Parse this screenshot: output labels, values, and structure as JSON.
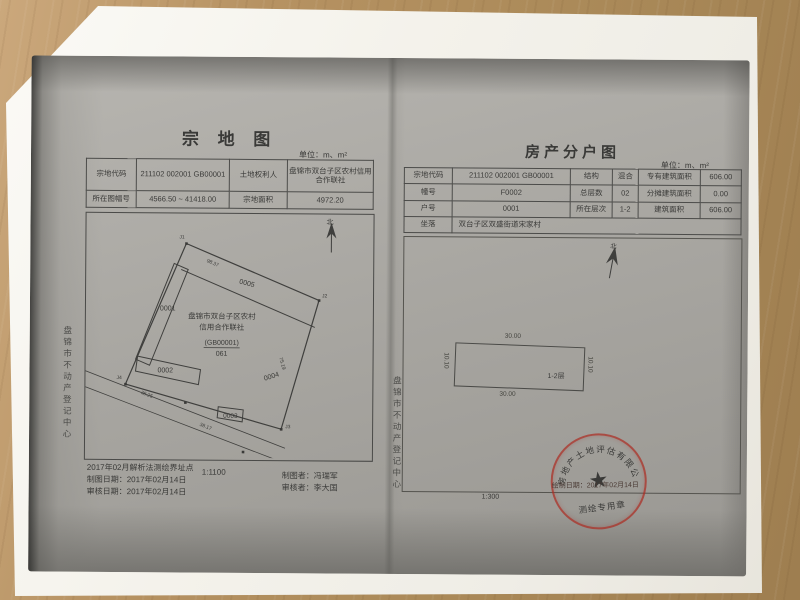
{
  "colors": {
    "stamp_red": "#ac2c22",
    "ink": "#3a3a38",
    "paper": "#f6f4ee",
    "copy_gray": "#a9a7a2",
    "desk_wood": "#b08c5e"
  },
  "left_page": {
    "title": "宗 地 图",
    "unit_label": "单位：m、m²",
    "header": {
      "parcel_code_label": "宗地代码",
      "parcel_code": "211102 002001 GB00001",
      "owner_label": "土地权利人",
      "owner": "盘锦市双台子区农村信用合作联社",
      "sheet_no_label": "所在图幅号",
      "sheet_no": "4566.50 ~ 41418.00",
      "area_label": "宗地面积",
      "area": "4972.20"
    },
    "map": {
      "north_label": "北",
      "owner_line1": "盘锦市双台子区农村",
      "owner_line2": "信用合作联社",
      "code": "(GB00001)",
      "sub_code": "061",
      "parcels": {
        "p1": "0001",
        "p2": "0002",
        "p3": "0003",
        "p4": "0004",
        "p5": "0005"
      },
      "measurements": {
        "top": "98.37",
        "right": "75.19",
        "road1": "38.25",
        "road2": "38.17"
      },
      "points": {
        "j1": "J1",
        "j2": "J2",
        "j3": "J3",
        "j4": "J4"
      }
    },
    "footer": {
      "note": "2017年02月解析法测绘界址点",
      "draw_date": "制图日期：2017年02月14日",
      "review_date": "审核日期：2017年02月14日",
      "scale": "1:1100",
      "drafter": "制图者：冯瑞军",
      "reviewer": "审核者：李大国"
    },
    "side_text": "盘锦市不动产登记中心"
  },
  "right_page": {
    "title": "房产分户图",
    "unit_label": "单位：m、m²",
    "table": {
      "rows": [
        {
          "c1": "宗地代码",
          "v1": "211102 002001 GB00001",
          "c2": "结构",
          "v2": "混合",
          "c3": "专有建筑面积",
          "v3": "606.00"
        },
        {
          "c1": "幢号",
          "v1": "F0002",
          "c2": "总层数",
          "v2": "02",
          "c3": "分摊建筑面积",
          "v3": "0.00"
        },
        {
          "c1": "户号",
          "v1": "0001",
          "c2": "所在层次",
          "v2": "1-2",
          "c3": "建筑面积",
          "v3": "606.00"
        },
        {
          "c1": "坐落",
          "v1": "双台子区双盛街道宋家村"
        }
      ]
    },
    "plan": {
      "north_label": "北",
      "top_dim": "30.00",
      "bottom_dim": "30.00",
      "left_dim": "10.10",
      "right_dim": "10.10",
      "room_label": "1-2层"
    },
    "scale": "1:300",
    "stamp": {
      "arc_text": "房地产土地评估有限公司",
      "bottom_text": "测绘专用章",
      "date_text": "绘制日期：2017年02月14日"
    },
    "side_text": "盘锦市不动产登记中心"
  }
}
